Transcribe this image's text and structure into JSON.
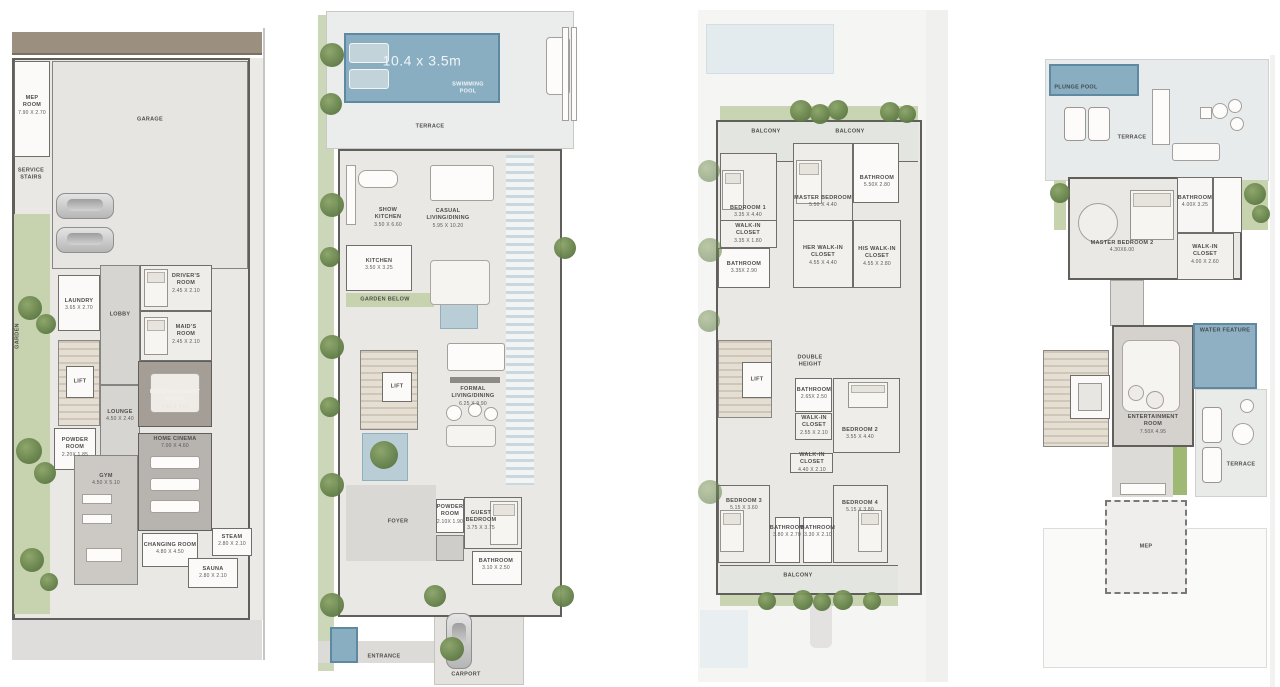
{
  "document": {
    "type": "villa-floor-plan-sheet",
    "background": "#ffffff"
  },
  "colors": {
    "pool_blue": "#8aaec1",
    "pool_border": "#5e89a1",
    "water_light": "#b9cdd6",
    "garden_green": "#c7d3ae",
    "tree_green": "#5e7a44",
    "wall_gray": "#605f5c",
    "floor_light": "#e9e8e5",
    "floor_dark": "#a49e97",
    "stair_beige": "#d9d1c3",
    "road_brown": "#9b9080"
  },
  "plans": [
    {
      "id": "basement-floor",
      "rooms": {
        "mep": {
          "label": "MEP\nROOM",
          "dims": "7.90 X 2.70"
        },
        "garage": {
          "label": "GARAGE"
        },
        "service_stairs": {
          "label": "SERVICE\nSTAIRS"
        },
        "garden": {
          "label": "GARDEN"
        },
        "laundry": {
          "label": "LAUNDRY",
          "dims": "3.65 X 2.70"
        },
        "lobby": {
          "label": "LOBBY"
        },
        "drivers_room": {
          "label": "DRIVER'S\nROOM",
          "dims": "2.45 X 2.10"
        },
        "maids_room": {
          "label": "MAID'S\nROOM",
          "dims": "2.45 X 2.10"
        },
        "lift": {
          "label": "LIFT"
        },
        "lounge": {
          "label": "LOUNGE",
          "dims": "4.50 X 2.40"
        },
        "entertainment_room": {
          "label": "ENTERTAINMENT\nROOM",
          "dims": "7.50 X 4.60"
        },
        "powder_room": {
          "label": "POWDER\nROOM",
          "dims": "2.20X 1.85"
        },
        "home_cinema": {
          "label": "HOME CINEMA",
          "dims": "7.00 X 4.60"
        },
        "gym": {
          "label": "GYM",
          "dims": "4.50 X 5.10"
        },
        "changing_room": {
          "label": "CHANGING ROOM",
          "dims": "4.80 X 4.50"
        },
        "steam": {
          "label": "STEAM",
          "dims": "2.80 X 2.10"
        },
        "sauna": {
          "label": "SAUNA",
          "dims": "2.80 X 2.10"
        }
      }
    },
    {
      "id": "ground-floor",
      "pool": {
        "size": "10.4 x 3.5m",
        "label": "SWIMMING\nPOOL"
      },
      "rooms": {
        "terrace": {
          "label": "TERRACE"
        },
        "show_kitchen": {
          "label": "SHOW\nKITCHEN",
          "dims": "3.50 X 6.60"
        },
        "casual_living": {
          "label": "CASUAL\nLIVING/DINING",
          "dims": "5.95 X 10.20"
        },
        "kitchen": {
          "label": "KITCHEN",
          "dims": "3.50 X 3.25"
        },
        "garden_below": {
          "label": "GARDEN BELOW"
        },
        "lift": {
          "label": "LIFT"
        },
        "formal_living": {
          "label": "FORMAL\nLIVING/DINING",
          "dims": "6.25 X 9.90"
        },
        "powder_room": {
          "label": "POWDER\nROOM",
          "dims": "2.10X 1.90"
        },
        "foyer": {
          "label": "FOYER"
        },
        "guest_bedroom": {
          "label": "GUEST\nBEDROOM",
          "dims": "3.75 X 3.75"
        },
        "bathroom": {
          "label": "BATHROOM",
          "dims": "3.10 X 2.50"
        },
        "entrance": {
          "label": "ENTRANCE"
        },
        "carport": {
          "label": "CARPORT"
        }
      }
    },
    {
      "id": "first-floor",
      "rooms": {
        "balcony_left": {
          "label": "BALCONY"
        },
        "balcony_right": {
          "label": "BALCONY"
        },
        "bedroom1": {
          "label": "BEDROOM 1",
          "dims": "3.35 X 4.40"
        },
        "master_bedroom": {
          "label": "MASTER BEDROOM",
          "dims": "5.50 X 4.40"
        },
        "master_bathroom": {
          "label": "BATHROOM",
          "dims": "5.50X 2.80"
        },
        "walkin_closet1": {
          "label": "WALK-IN\nCLOSET",
          "dims": "3.35 X 1.80"
        },
        "bathroom1": {
          "label": "BATHROOM",
          "dims": "3.35X 2.90"
        },
        "her_walkin": {
          "label": "HER WALK-IN\nCLOSET",
          "dims": "4.55 X 4.40"
        },
        "his_walkin": {
          "label": "HIS WALK-IN\nCLOSET",
          "dims": "4.55 X 2.80"
        },
        "double_height": {
          "label": "DOUBLE\nHEIGHT"
        },
        "lift": {
          "label": "LIFT"
        },
        "bathroom2": {
          "label": "BATHROOM",
          "dims": "2.65X 2.50"
        },
        "walkin_closet2": {
          "label": "WALK-IN\nCLOSET",
          "dims": "2.55 X 2.10"
        },
        "bedroom2": {
          "label": "BEDROOM 2",
          "dims": "3.55 X 4.40"
        },
        "walkin_closet3": {
          "label": "WALK-IN\nCLOSET",
          "dims": "4.40 X 2.10"
        },
        "bedroom3": {
          "label": "BEDROOM 3",
          "dims": "5.15 X 3.60"
        },
        "bathroom3": {
          "label": "BATHROOM",
          "dims": "3.80 X 2.70"
        },
        "bathroom4": {
          "label": "BATHROOM",
          "dims": "3.30 X 2.10"
        },
        "bedroom4": {
          "label": "BEDROOM 4",
          "dims": "5.15 X 3.80"
        },
        "balcony_bottom": {
          "label": "BALCONY"
        }
      }
    },
    {
      "id": "second-floor",
      "rooms": {
        "plunge_pool": {
          "label": "PLUNGE POOL"
        },
        "terrace_top": {
          "label": "TERRACE"
        },
        "master_bedroom2": {
          "label": "MASTER BEDROOM 2",
          "dims": "4.30X6.00"
        },
        "bathroom": {
          "label": "BATHROOM",
          "dims": "4.00X 3.25"
        },
        "walkin_closet": {
          "label": "WALK-IN\nCLOSET",
          "dims": "4.00 X 2.60"
        },
        "water_feature": {
          "label": "WATER FEATURE"
        },
        "entertainment_room": {
          "label": "ENTERTAINMENT\nROOM",
          "dims": "7.50X 4.95"
        },
        "terrace_mid": {
          "label": "TERRACE"
        },
        "mep": {
          "label": "MEP"
        }
      }
    }
  ]
}
